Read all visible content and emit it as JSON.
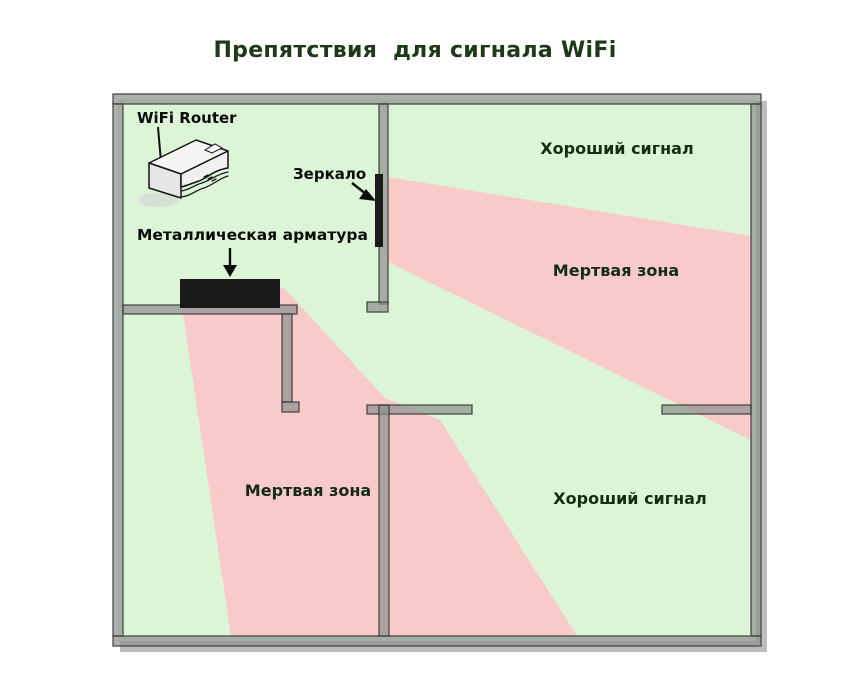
{
  "title": "Препятствия  для сигнала WiFi",
  "labels": {
    "router": "WiFi Router",
    "mirror": "Зеркало",
    "metal_rebar": "Металлическая арматура",
    "good_signal_top": "Хороший сигнал",
    "dead_zone_right": "Мертвая зона",
    "dead_zone_bottom_left": "Мертвая зона",
    "good_signal_bottom": "Хороший сигнал"
  },
  "colors": {
    "good_signal": "#dcf5d7",
    "dead_zone": "#f8caca",
    "wall": "#8f928e",
    "obstacle_black": "#1a1a1a",
    "shadow": "#bdbdbd"
  }
}
